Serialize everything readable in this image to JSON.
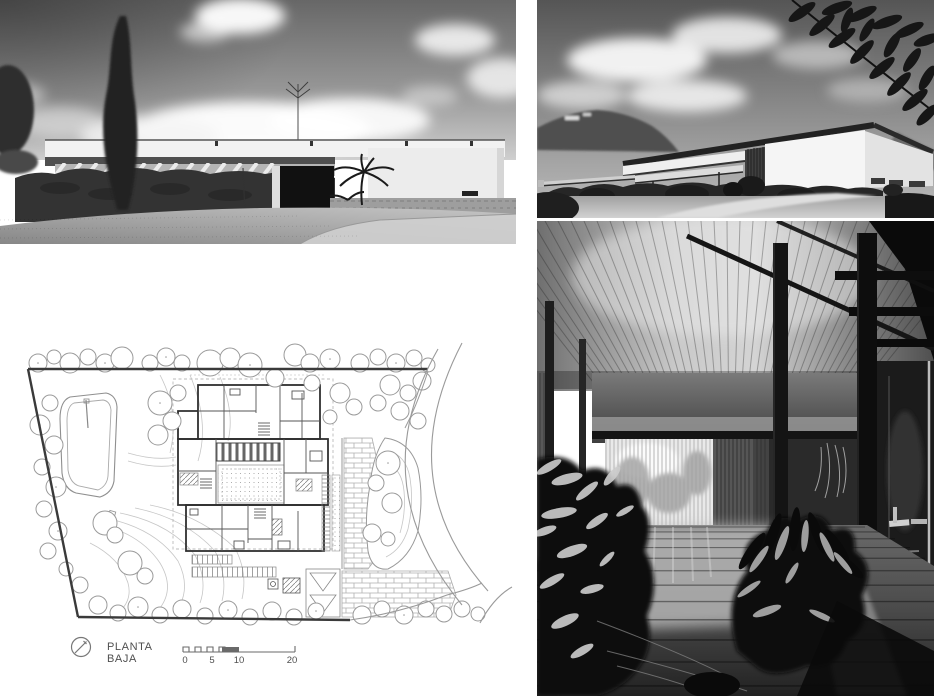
{
  "plan": {
    "label": "PLANTA BAJA",
    "scale_ticks": [
      "0",
      "5",
      "10",
      "20"
    ]
  },
  "palette": {
    "paper": "#ffffff",
    "plan_line": "#9a9a9a",
    "plan_wall": "#2f2f2f",
    "legend_text": "#4f4f4f",
    "photo_dark": "#111111",
    "photo_light": "#f2f2f2"
  },
  "icons": {
    "north_arrow": "north-arrow-icon"
  }
}
